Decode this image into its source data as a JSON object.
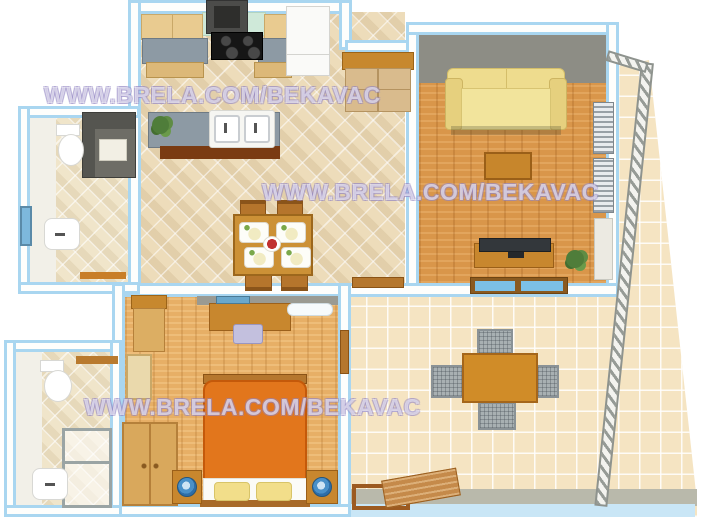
{
  "title": "3D apartment floor plan render",
  "watermark": {
    "text": "WWW.BRELA.COM/BEKAVAC"
  },
  "colors": {
    "wall_outline": "#a9d6f0",
    "wall_fill": "#fefefc",
    "inner_wall_gray": "#8d8d85",
    "tile_beige": "#eddcba",
    "terrace_tile": "#f5e4c2",
    "wood_living": "#d9964a",
    "wood_bedroom": "#e7af66",
    "sofa_yellow": "#f0dd90",
    "bed_duvet_orange": "#e2761c",
    "pillow_yellow": "#f2de8a",
    "wood_furniture": "#c8872e",
    "counter_gray": "#8d9aa4",
    "backsplash_mint": "#cfe9d9",
    "stove_black": "#161616",
    "fridge_white": "#fafaf8",
    "railing_gray": "#9ba09b",
    "outdoor_chair_gray": "#a8b0b2",
    "lamp_blue": "#4a90c8",
    "window_blue": "#7cc0e6",
    "plant_green": "#4f7d3a",
    "terrace_edge_gray": "#b9b9ab"
  },
  "rooms": [
    {
      "id": "bathroom-top-left",
      "furniture": [
        "toilet",
        "shower-cabin",
        "washbasin",
        "window"
      ]
    },
    {
      "id": "kitchen-dining",
      "furniture": [
        "range-hood",
        "cooktop",
        "backsplash",
        "upper-cabinets",
        "counters",
        "refrigerator",
        "sink-island",
        "double-sink",
        "plant",
        "hall-cabinet",
        "dining-table",
        "dining-chairs-x4",
        "place-settings-x4",
        "fruit-bowl",
        "terrace-door-threshold"
      ]
    },
    {
      "id": "living-room",
      "furniture": [
        "sofa",
        "coffee-table",
        "tv-stand",
        "tv",
        "plant",
        "window",
        "shutters",
        "balcony-door"
      ]
    },
    {
      "id": "balcony",
      "furniture": [
        "railing"
      ]
    },
    {
      "id": "bedroom",
      "furniture": [
        "double-bed",
        "pillows-x2",
        "nightstands-x2",
        "bedside-lamps-x2",
        "wardrobe",
        "desk",
        "desk-chair",
        "air-conditioner",
        "corner-cabinet",
        "room-door",
        "terrace-door",
        "window"
      ]
    },
    {
      "id": "bathroom-bottom-left",
      "furniture": [
        "toilet",
        "washbasin",
        "shower-enclosure",
        "shelf"
      ]
    },
    {
      "id": "terrace",
      "furniture": [
        "outdoor-table",
        "outdoor-chairs-x4",
        "sun-lounger",
        "railing"
      ]
    }
  ]
}
